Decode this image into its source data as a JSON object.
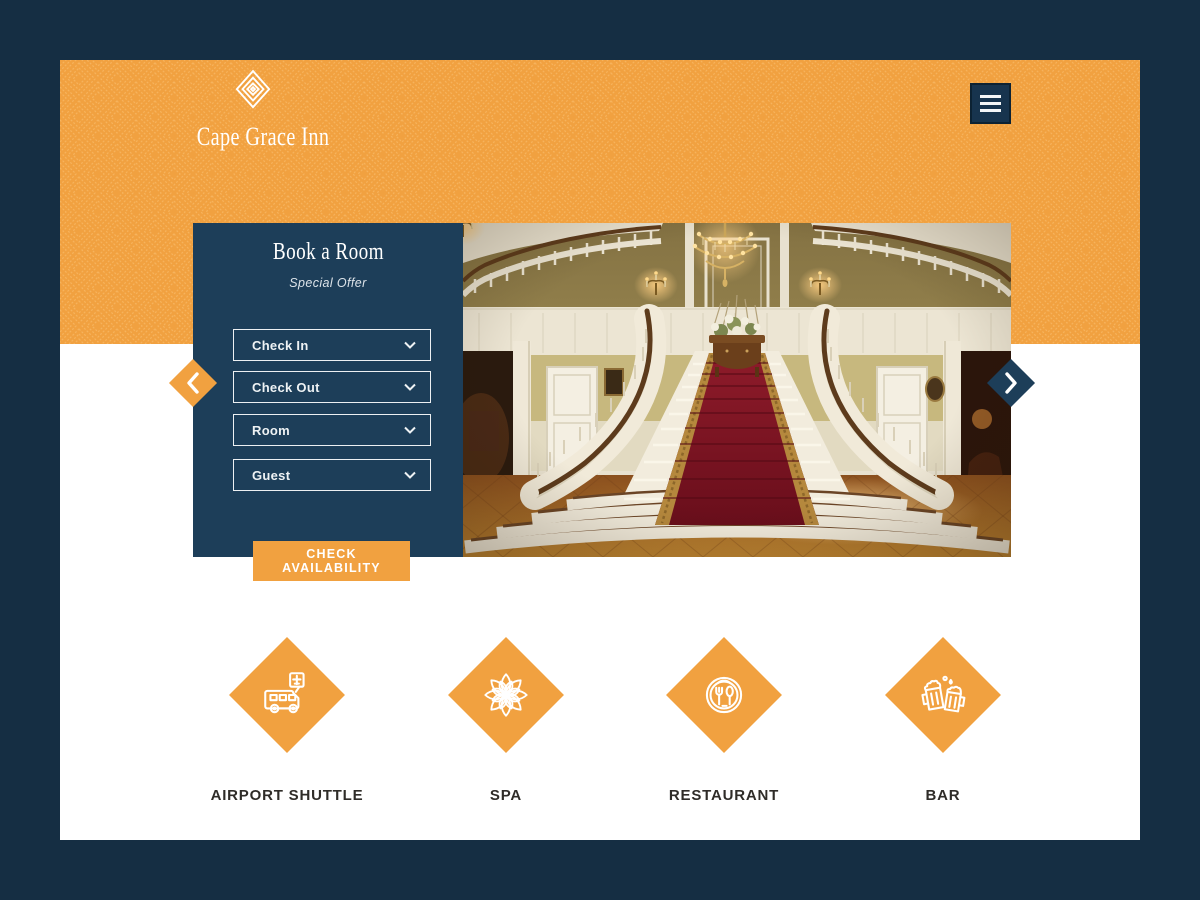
{
  "colors": {
    "page_background": "#152E43",
    "header_orange": "#F1A140",
    "pattern_line": "#FFD18C",
    "panel_navy": "#1D3E59",
    "menu_button_navy": "#17344E",
    "cta_orange": "#F1A140",
    "service_diamond_orange": "#F1A140",
    "label_text": "#2F2C28"
  },
  "header": {
    "brand": "Cape Grace Inn",
    "logo_icon": "concentric-diamond-logo",
    "menu_icon": "hamburger"
  },
  "booking": {
    "title": "Book a Room",
    "subtitle": "Special Offer",
    "fields": [
      {
        "label": "Check In",
        "icon": "chevron-down"
      },
      {
        "label": "Check Out",
        "icon": "chevron-down"
      },
      {
        "label": "Room",
        "icon": "chevron-down"
      },
      {
        "label": "Guest",
        "icon": "chevron-down"
      }
    ],
    "cta": "CHECK AVAILABILITY"
  },
  "carousel": {
    "prev_icon": "chevron-left",
    "next_icon": "chevron-right",
    "slide_alt": "grand double staircase with red carpet runner, chandelier and wall sconces"
  },
  "services": [
    {
      "label": "AIRPORT SHUTTLE",
      "icon": "shuttle-bus-airport-sign"
    },
    {
      "label": "SPA",
      "icon": "lotus-flower-mandala"
    },
    {
      "label": "RESTAURANT",
      "icon": "plate-fork-spoon"
    },
    {
      "label": "BAR",
      "icon": "clinking-beer-mugs"
    }
  ]
}
